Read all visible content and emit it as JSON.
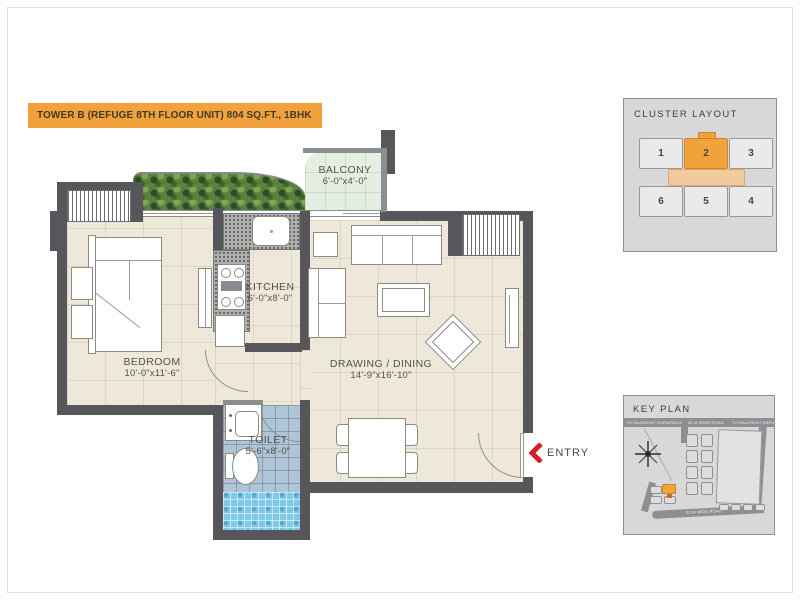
{
  "title_bar": {
    "text": "TOWER B (REFUGE 8TH FLOOR UNIT) 804 SQ.FT., 1BHK"
  },
  "colors": {
    "accent_orange": "#F2A23B",
    "wall_gray": "#57575B",
    "entry_red": "#D22027",
    "floor_cream": "#EDE8DA",
    "balcony_green": "#E4EFE1",
    "toilet_blue": "#AFC4D4",
    "shower_blue": "#7EC9E6",
    "panel_gray": "#D8D8D8",
    "corridor_peach": "#F3CA9E"
  },
  "floor_plan": {
    "rooms": {
      "balcony": {
        "name": "BALCONY",
        "dims": "6'-0\"x4'-0\""
      },
      "kitchen": {
        "name": "KITCHEN",
        "dims": "6'-0\"x8'-0\""
      },
      "bedroom": {
        "name": "BEDROOM",
        "dims": "10'-0\"x11'-6\""
      },
      "drawing_dining": {
        "name": "DRAWING / DINING",
        "dims": "14'-9\"x16'-10\""
      },
      "toilet": {
        "name": "TOILET",
        "dims": "5'-6\"x8'-0\""
      }
    },
    "entry_label": "ENTRY"
  },
  "cluster_layout": {
    "title": "CLUSTER LAYOUT",
    "top_row": [
      "1",
      "2",
      "3"
    ],
    "bottom_row": [
      "6",
      "5",
      "4"
    ],
    "highlighted_unit": "2"
  },
  "key_plan": {
    "title": "KEY PLAN",
    "road_labels": {
      "top_left": "TO RAJARHAT CHOWRAHA",
      "top_center": "30 M WIDE ROAD",
      "top_right": "TO RAJARHAT SAPURJI",
      "bottom": "30 M WIDE ROAD"
    }
  }
}
